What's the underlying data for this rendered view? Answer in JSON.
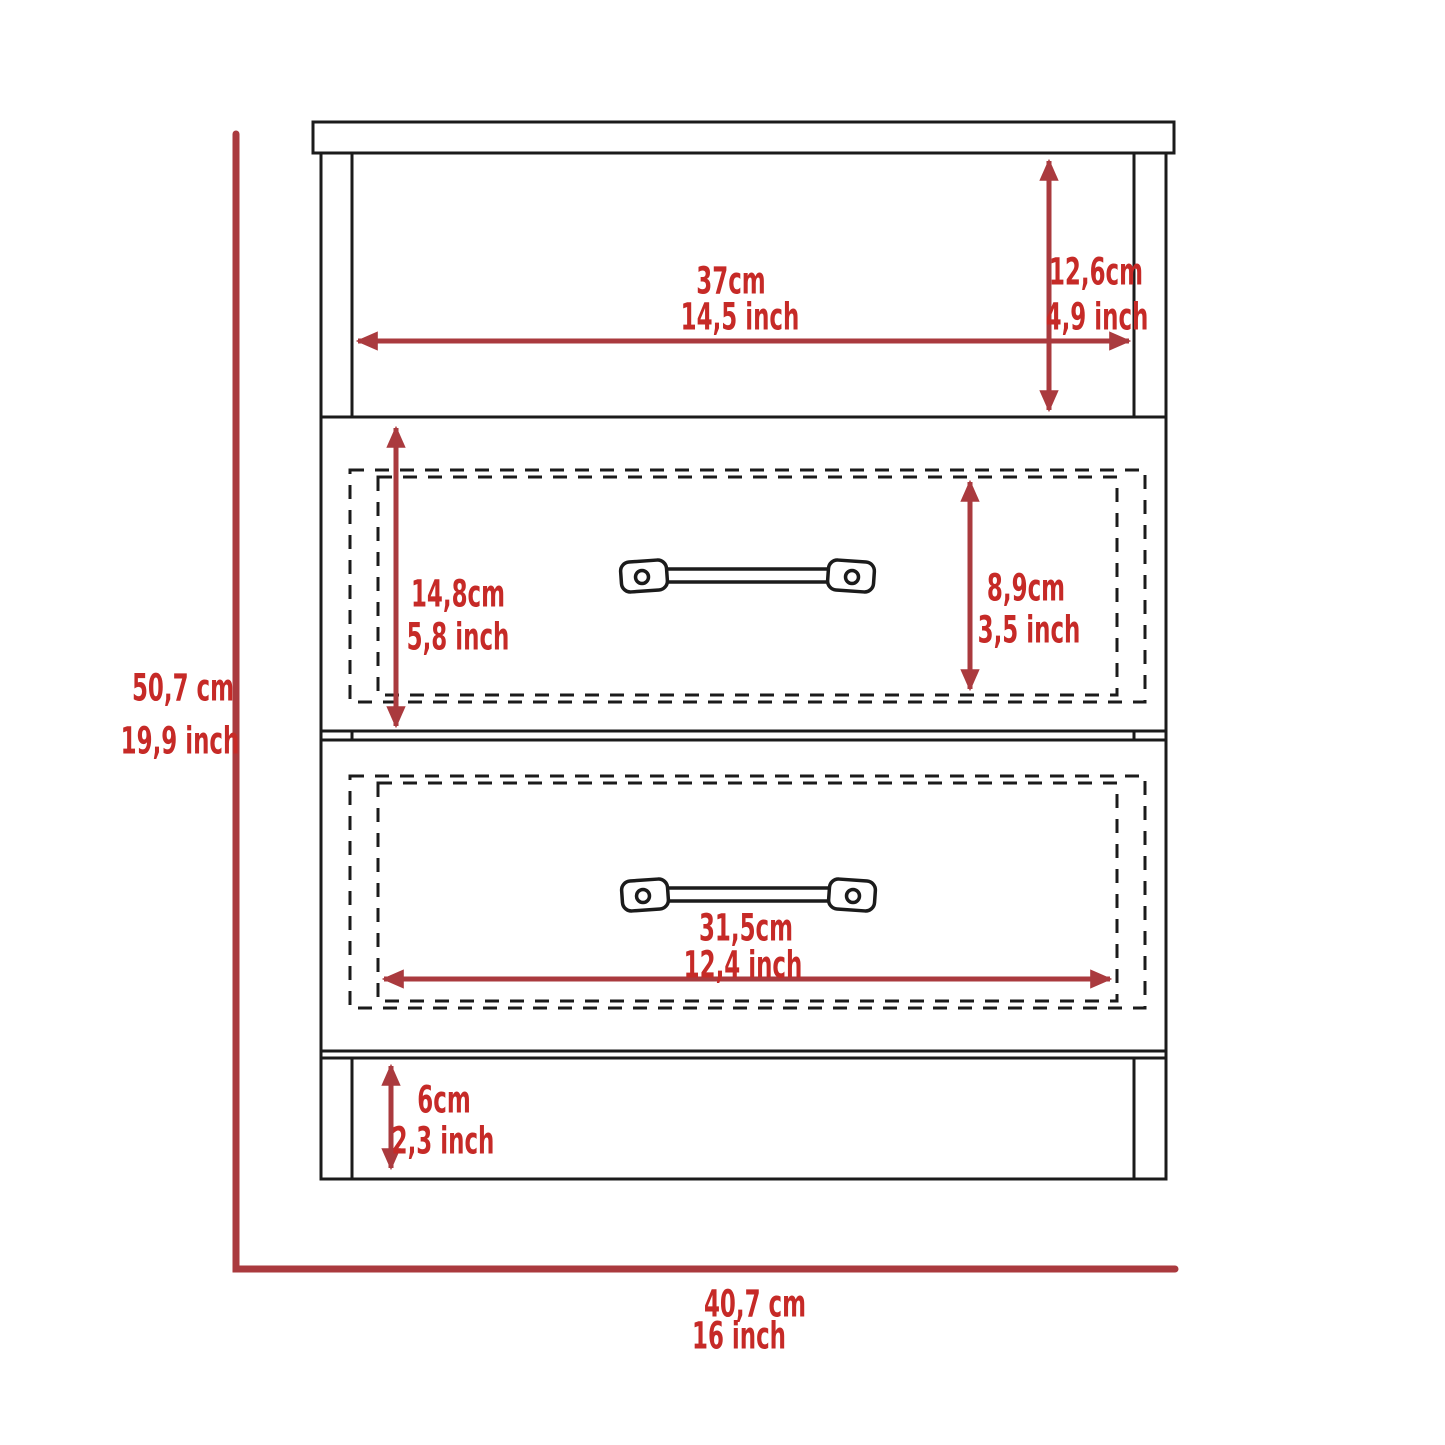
{
  "figure": {
    "title": "Two-drawer nightstand dimension diagram (front view)",
    "colors": {
      "dimension_red": "#AA3A3E",
      "label_red": "#C62A27",
      "line_black": "#1B1B1B",
      "background": "#FFFFFF"
    },
    "dimensions": {
      "opening_width": {
        "cm": "37cm",
        "inch": "14,5 inch"
      },
      "opening_height": {
        "cm": "12,6cm",
        "inch": "4,9 inch"
      },
      "drawer_front_height": {
        "cm": "14,8cm",
        "inch": "5,8 inch"
      },
      "drawer_inner_height": {
        "cm": "8,9cm",
        "inch": "3,5 inch"
      },
      "drawer_inner_width": {
        "cm": "31,5cm",
        "inch": "12,4 inch"
      },
      "base_height": {
        "cm": "6cm",
        "inch": "2,3 inch"
      },
      "overall_height": {
        "cm": "50,7 cm",
        "inch": "19,9 inch"
      },
      "overall_width": {
        "cm": "40,7 cm",
        "inch": "16 inch"
      }
    }
  }
}
